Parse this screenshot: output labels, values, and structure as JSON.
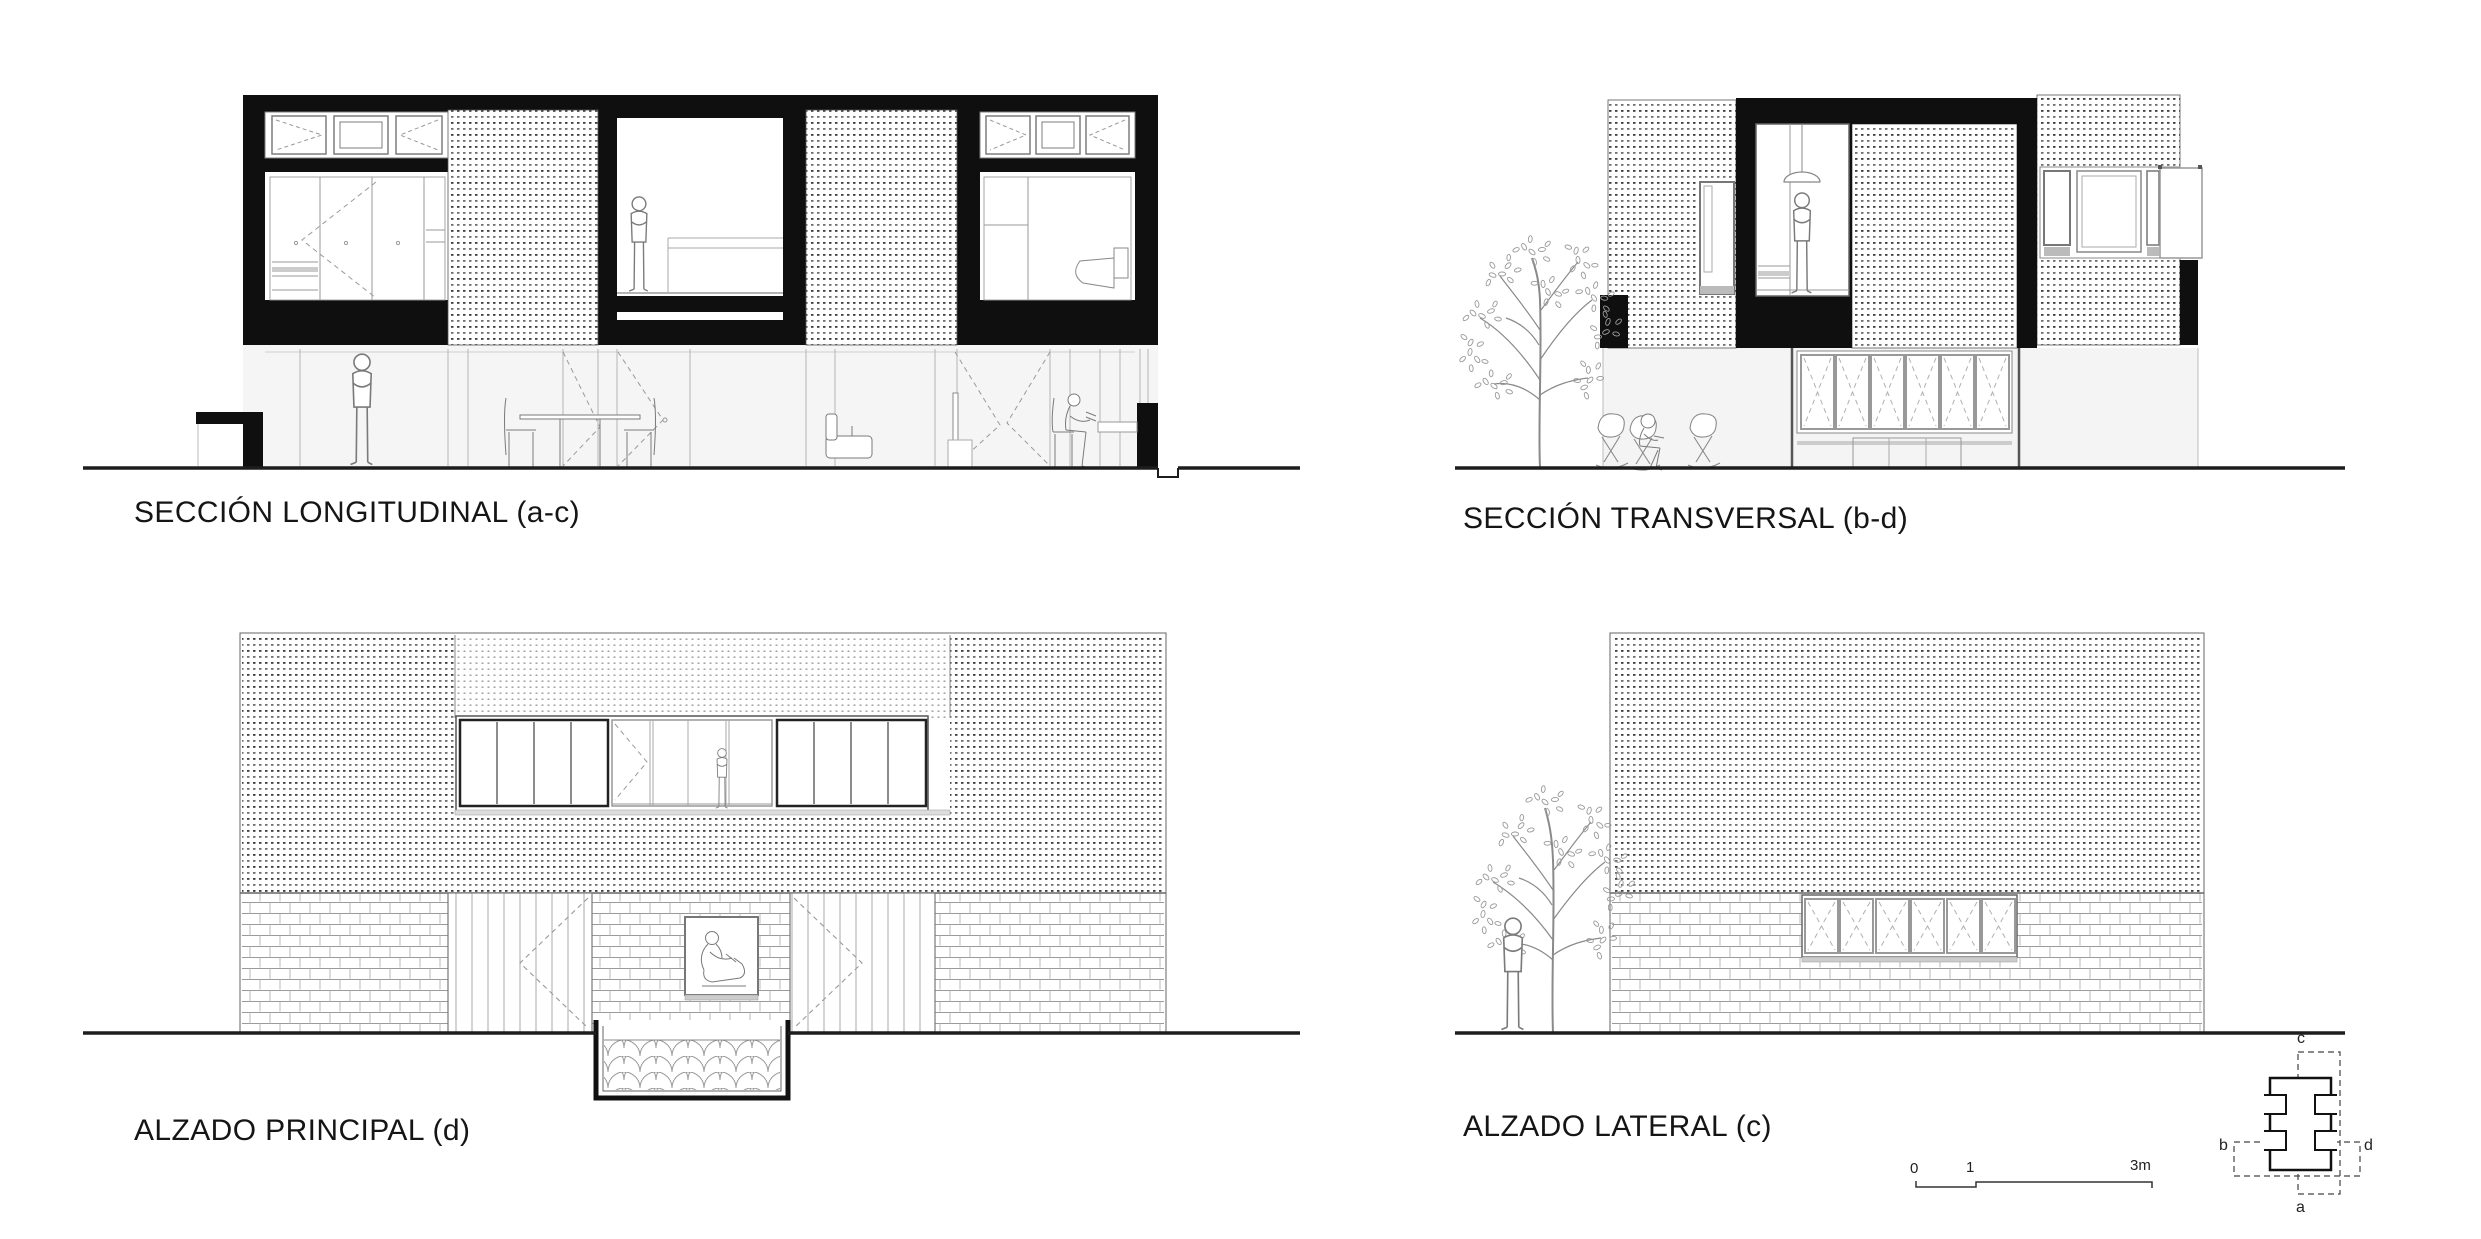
{
  "sheet": {
    "title_labels": {
      "longitudinal_section": "SECCIÓN LONGITUDINAL (a-c)",
      "transversal_section": "SECCIÓN TRANSVERSAL (b-d)",
      "principal_elevation": "ALZADO PRINCIPAL (d)",
      "lateral_elevation": "ALZADO LATERAL (c)"
    },
    "scale_bar": {
      "tick_start": "0",
      "tick_mid": "1",
      "tick_end": "3m"
    },
    "key_plan": {
      "top": "c",
      "bottom": "a",
      "left": "b",
      "right": "d"
    },
    "palette": {
      "ink": "#0f0f0f",
      "line": "#777777",
      "light_line": "#aaaaaa",
      "wash": "#f4f4f4",
      "paper": "#ffffff"
    }
  }
}
